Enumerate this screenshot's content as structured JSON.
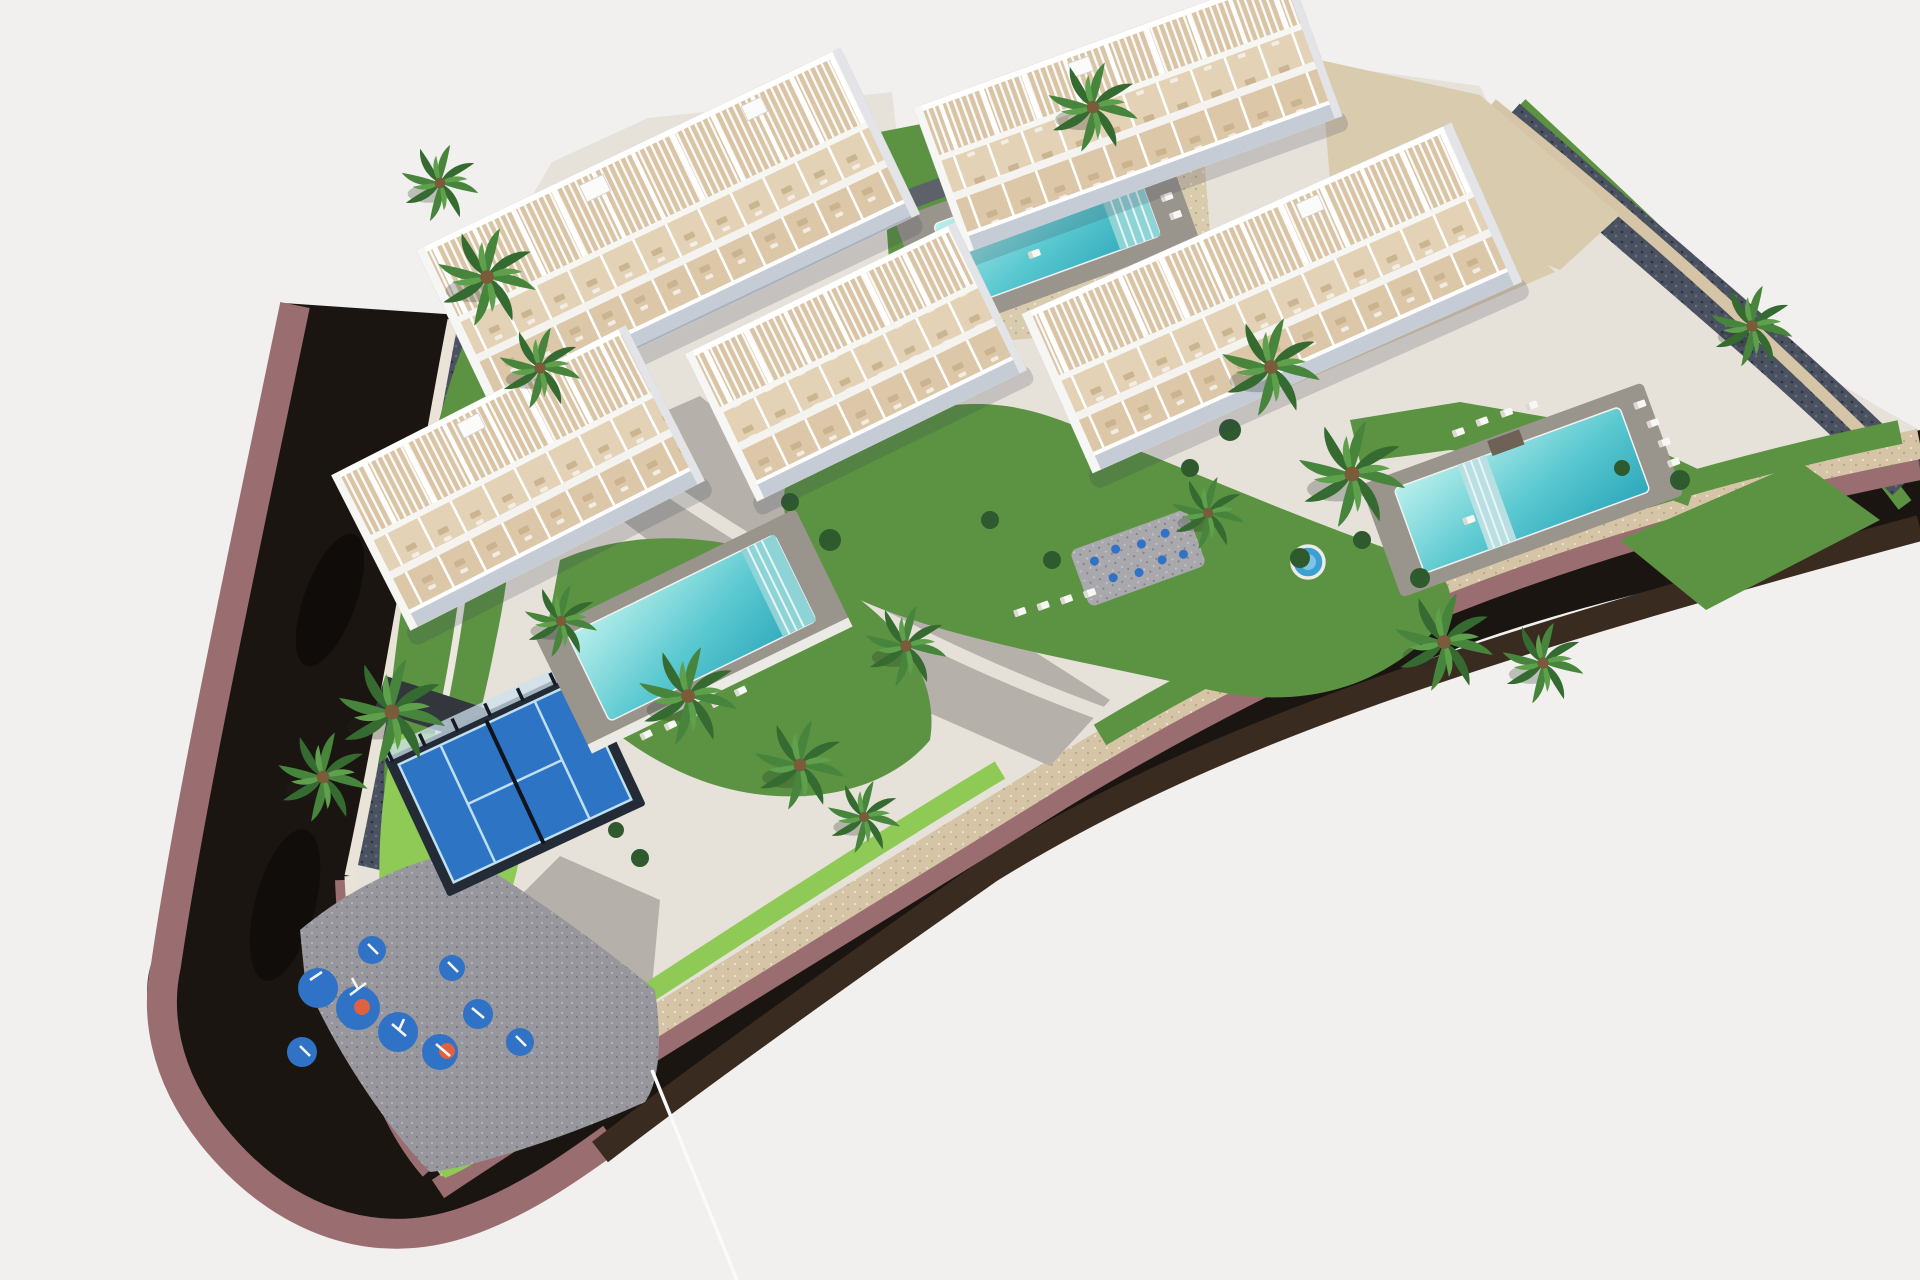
{
  "image": {
    "kind": "3d-aerial-architectural-rendering",
    "subject": "gated residential apartment complex with pools, padel court, playground and perimeter road"
  },
  "inventory": {
    "apartment_buildings": 5,
    "swimming_pools": 3,
    "kids_round_pool": 1,
    "splash_pad": 1,
    "padel_court": 1,
    "playground": 1,
    "perimeter_road": 1,
    "palm_trees": 17
  },
  "colors": {
    "background": "#f2f0ee",
    "road-asphalt": "#1b1511",
    "road-wall-brown": "#3a2b20",
    "sidewalk-mauve": "#9a6e71",
    "stone-tan": "#d5c5a6",
    "stone-light": "#e9e3d8",
    "pebble-slope": "#4a5160",
    "grass": "#5b9342",
    "lawn-bright": "#8fca57",
    "foliage-dark": "#2e5a2e",
    "palm-green": "#3f7c39",
    "pavement-gray": "#b5b1aa",
    "pavement-light": "#e6e2da",
    "gravel-tan": "#d9cbae",
    "pool-water": "#53c6cd",
    "pool-deck": "#99948c",
    "padel-blue": "#2e74c4",
    "padel-fence": "#232b37",
    "playground-blue": "#2f72c6",
    "playground-orange": "#e0613f",
    "playground-pad": "#97979d",
    "building-white": "#fdfdfc",
    "building-shade": "#c6ccd5",
    "terrace-tan": "#dcc7a8",
    "kids-pool-blue": "#3e9fd2",
    "driveway-dark": "#33363d"
  }
}
